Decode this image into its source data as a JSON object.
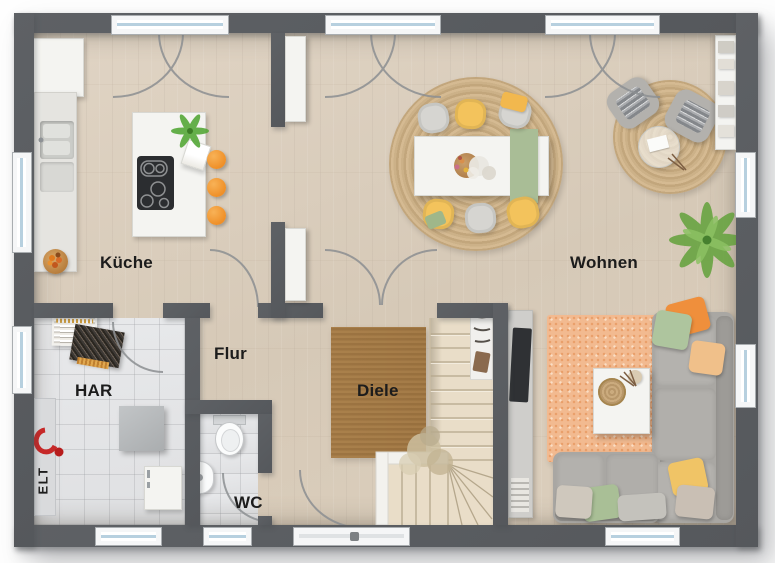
{
  "rooms": {
    "kueche": {
      "label": "Küche"
    },
    "wohnen": {
      "label": "Wohnen"
    },
    "flur": {
      "label": "Flur"
    },
    "diele": {
      "label": "Diele"
    },
    "har": {
      "label": "HAR"
    },
    "wc": {
      "label": "WC"
    },
    "elt": {
      "label": "ELT"
    }
  },
  "colors": {
    "wall": "#55585c",
    "wood_floor": "#dbcfbe",
    "tile_floor": "#e4e5e7",
    "stool_orange": "#ef8f27",
    "chair_yellow": "#f3c35c",
    "chair_gray": "#d6d5d1",
    "runner_green": "#a9bd96",
    "jute_rug": "#cdb189",
    "living_rug": "#f2ba90",
    "sofa_gray": "#a9a7a3",
    "plant_green": "#66a33f",
    "accent_red": "#c62828"
  }
}
